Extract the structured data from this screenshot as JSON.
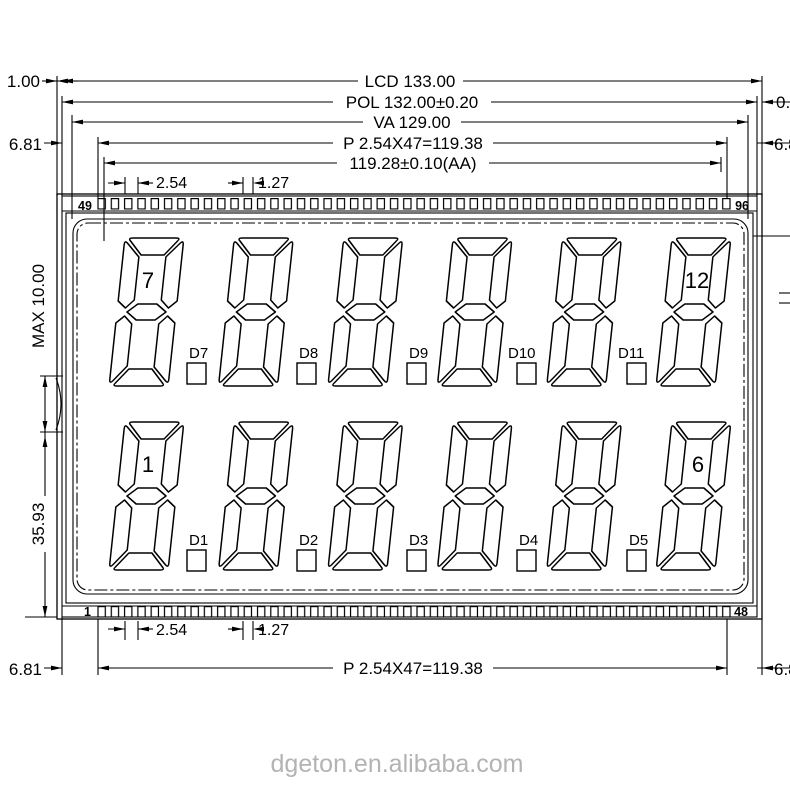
{
  "watermark": "dgeton.en.alibaba.com",
  "dims": {
    "lcd": "LCD 133.00",
    "pol": "POL 132.00±0.20",
    "va": "VA 129.00",
    "pin_pitch": "P 2.54X47=119.38",
    "active_area": "119.28±0.10(AA)",
    "pitch": "2.54",
    "half_pitch": "1.27",
    "pol_offset": "1.00",
    "pol_offset_right": "0.",
    "edge_margin": "6.81",
    "max_thickness": "MAX 10.00",
    "lower_height": "35.93"
  },
  "pins": {
    "top_left": "49",
    "top_right": "96",
    "bottom_left": "1",
    "bottom_right": "48"
  },
  "digit_labels": {
    "top_first": "7",
    "top_last": "12",
    "bottom_first": "1",
    "bottom_last": "6"
  },
  "decimals": {
    "top": [
      "D7",
      "D8",
      "D9",
      "D10",
      "D11"
    ],
    "bottom": [
      "D1",
      "D2",
      "D3",
      "D4",
      "D5"
    ]
  }
}
